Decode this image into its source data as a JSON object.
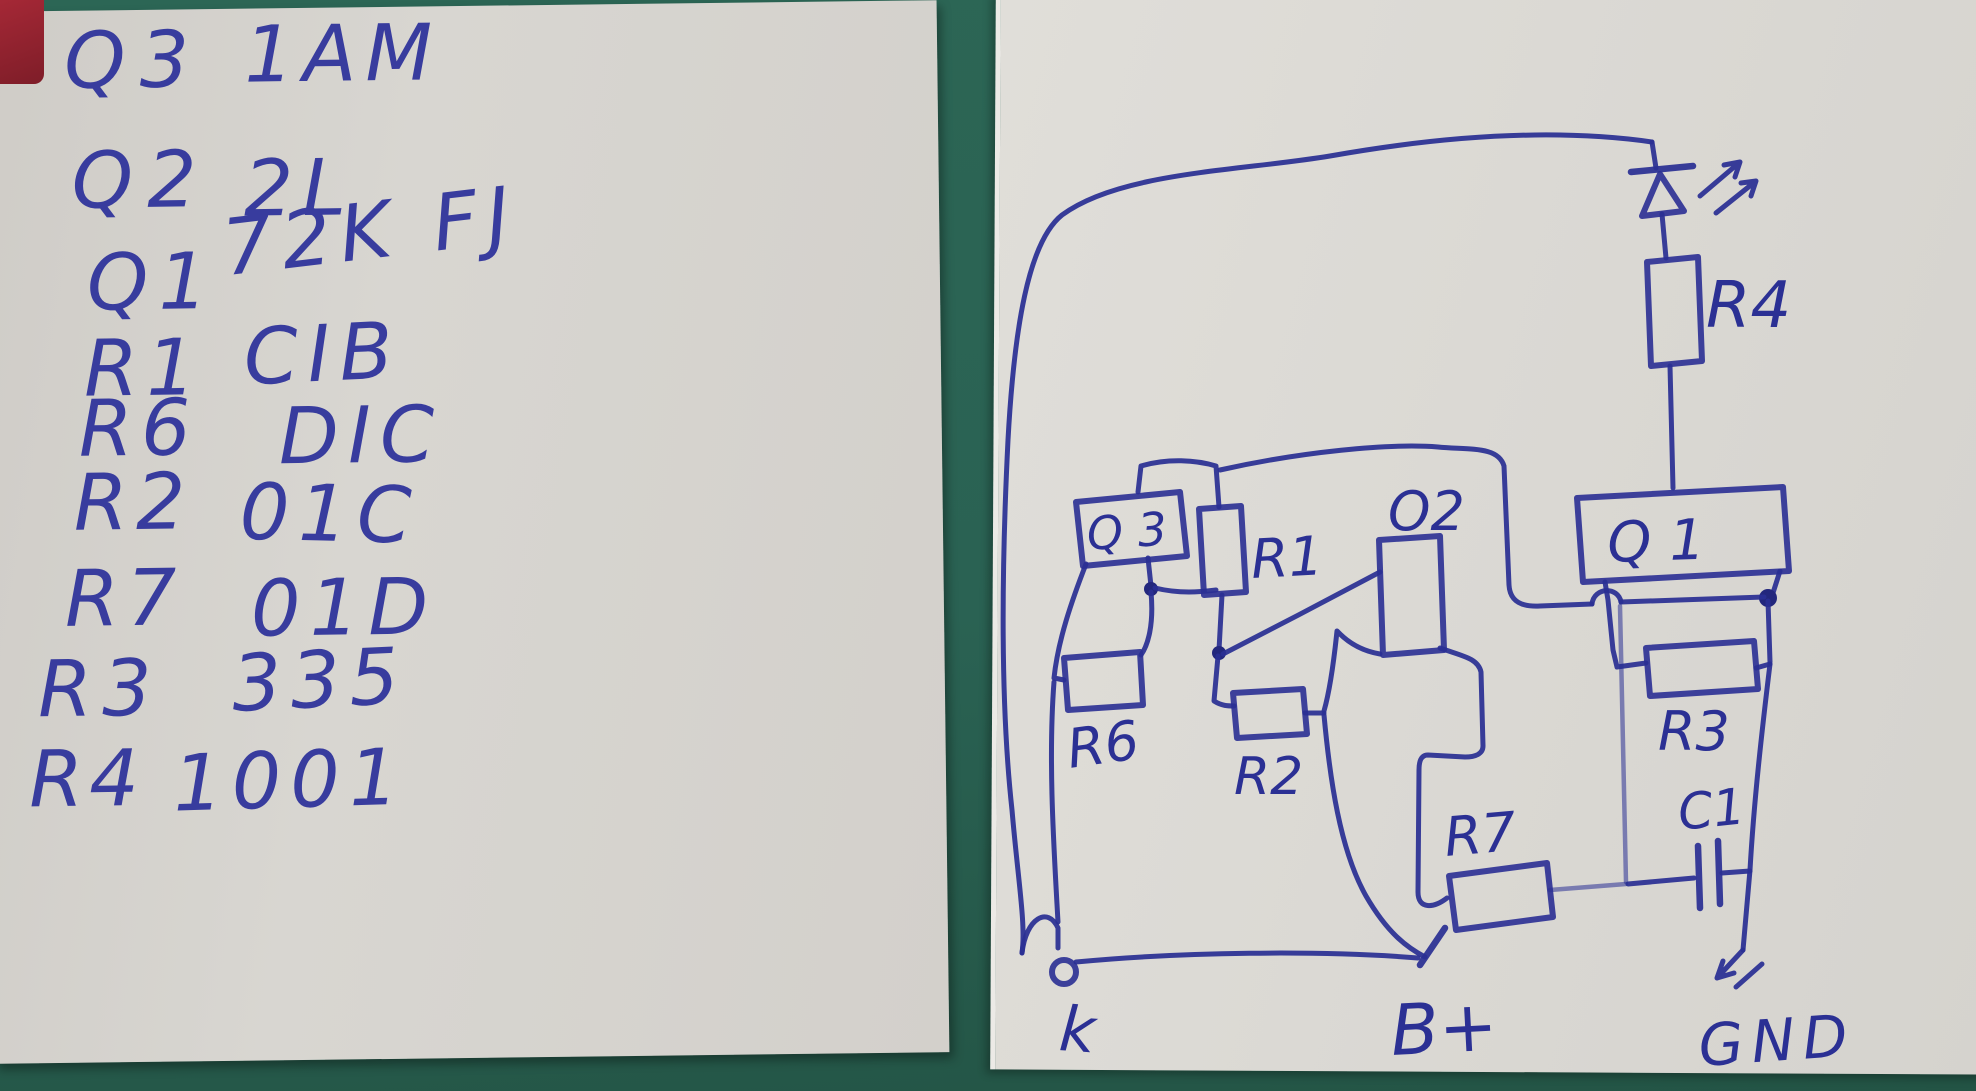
{
  "scene": {
    "background_color": "#2a6253",
    "paper_left_color": "#d5d3ce",
    "paper_right_color": "#dbd9d4",
    "ink_blue": "#2a2f93",
    "red_patch_color": "#a52836"
  },
  "notes": {
    "rows": [
      {
        "label": "Q3",
        "value": "1AM"
      },
      {
        "label": "Q2",
        "value": "2L"
      },
      {
        "label": "Q1",
        "value": "72K FJ"
      },
      {
        "label": "R1",
        "value": "CIB"
      },
      {
        "label": "R6",
        "value": "DIC"
      },
      {
        "label": "R2",
        "value": "01C"
      },
      {
        "label": "R7",
        "value": "01D"
      },
      {
        "label": "R3",
        "value": "335"
      },
      {
        "label": "R4",
        "value": "1001"
      }
    ]
  },
  "schematic": {
    "labels": {
      "q3": "Q 3",
      "r1": "R1",
      "q2": "O2",
      "q1": "Q 1",
      "r4": "R4",
      "r6": "R6",
      "r2": "R2",
      "r3": "R3",
      "r7": "R7",
      "c1": "C1"
    },
    "terminals": {
      "k": "k",
      "b_plus": "B+",
      "gnd": "GND"
    }
  }
}
